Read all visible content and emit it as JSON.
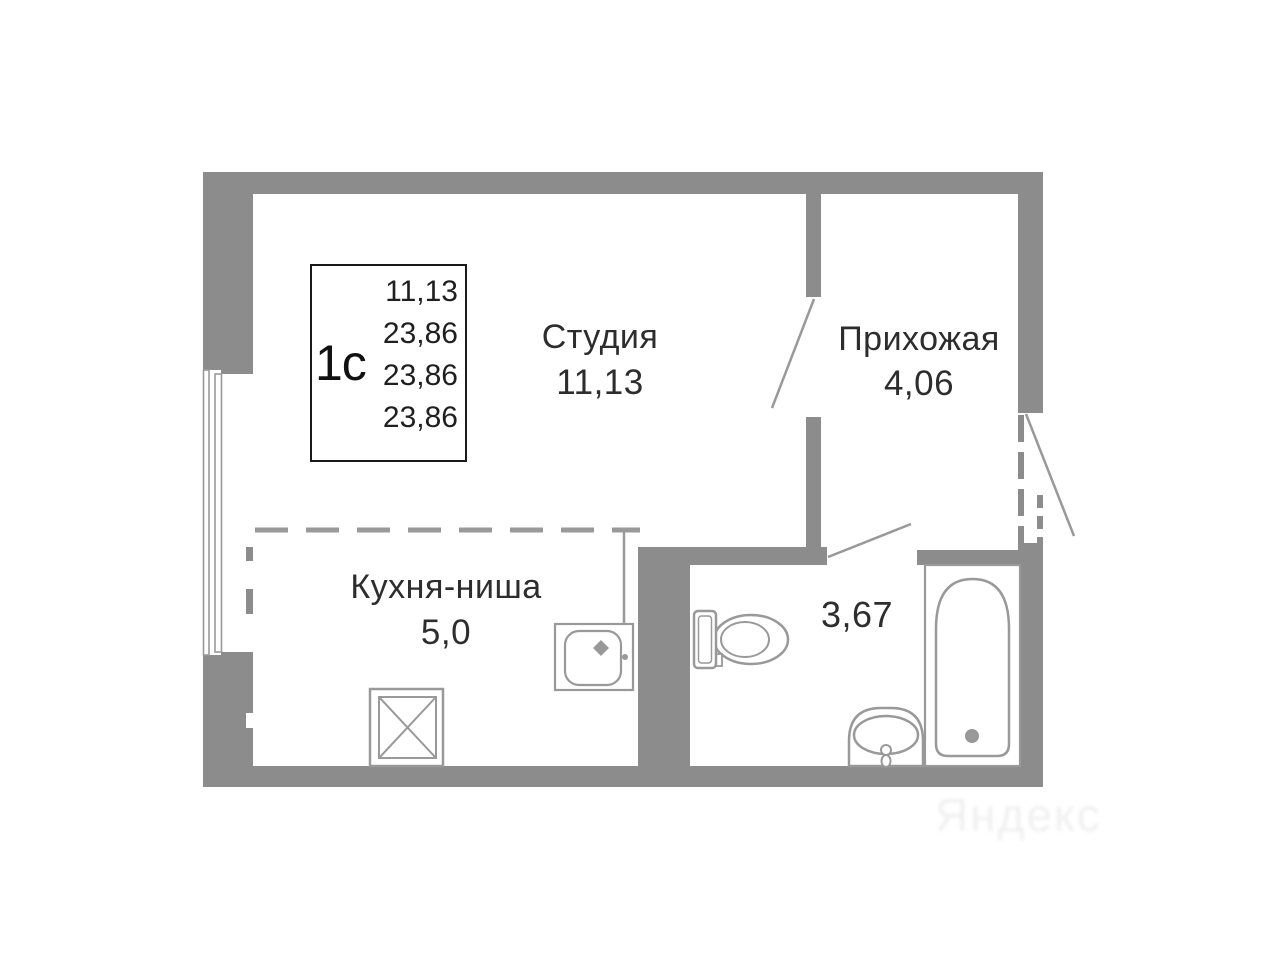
{
  "title_box": {
    "unit": "1с",
    "areas": [
      "11,13",
      "23,86",
      "23,86",
      "23,86"
    ]
  },
  "rooms": {
    "studio": {
      "name": "Студия",
      "area": "11,13"
    },
    "hallway": {
      "name": "Прихожая",
      "area": "4,06"
    },
    "kitchen": {
      "name": "Кухня-ниша",
      "area": "5,0"
    },
    "bathroom": {
      "area": "3,67"
    }
  },
  "fixtures": [
    "window",
    "entrance-door",
    "interior-door",
    "bathroom-door",
    "kitchen-sink",
    "stove",
    "toilet",
    "bathroom-sink",
    "bathtub"
  ],
  "watermark": "Яндекс",
  "colors": {
    "wall": "#8c8c8c",
    "fixture_line": "#999999",
    "text": "#2d2d2d",
    "box_border": "#1a1a1a",
    "background": "#ffffff"
  }
}
